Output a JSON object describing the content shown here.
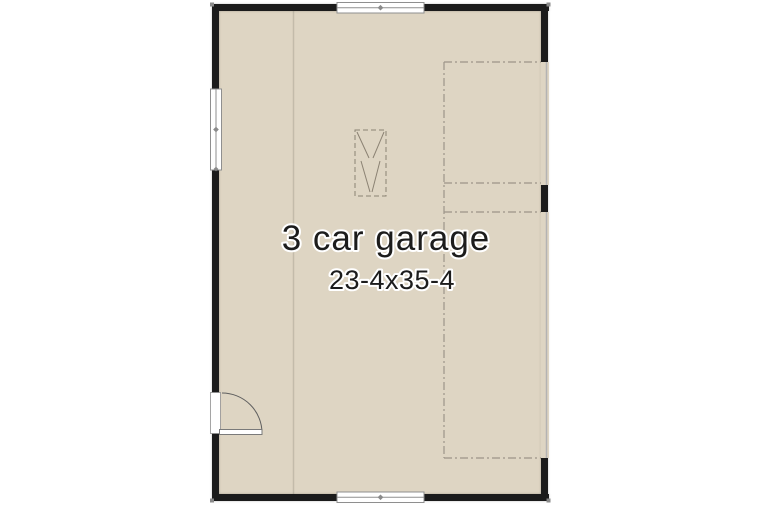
{
  "room": {
    "label": "3 car garage",
    "dimensions": "23-4x35-4"
  },
  "colors": {
    "background": "#ffffff",
    "floor": "#ded5c3",
    "wall": "#1b1b1b",
    "window_frame": "#8f8f8f",
    "window_fill": "#ffffff",
    "divider_line": "#c3bbaa",
    "dashed_line": "#9d9589",
    "symbol_line": "#8b8273",
    "marker": "#8a8a8a",
    "text": "#1c1c1c"
  },
  "symbols": {
    "windows": [
      "window-top",
      "window-left",
      "window-bottom"
    ],
    "door": "entry-door-with-swing-arc",
    "garage_door_openings": [
      "single-garage-door-opening",
      "double-garage-door-opening"
    ],
    "overhead_tracks": "dash-dot-garage-door-track-lines",
    "attic_access": "dashed-attic-access-symbol"
  }
}
